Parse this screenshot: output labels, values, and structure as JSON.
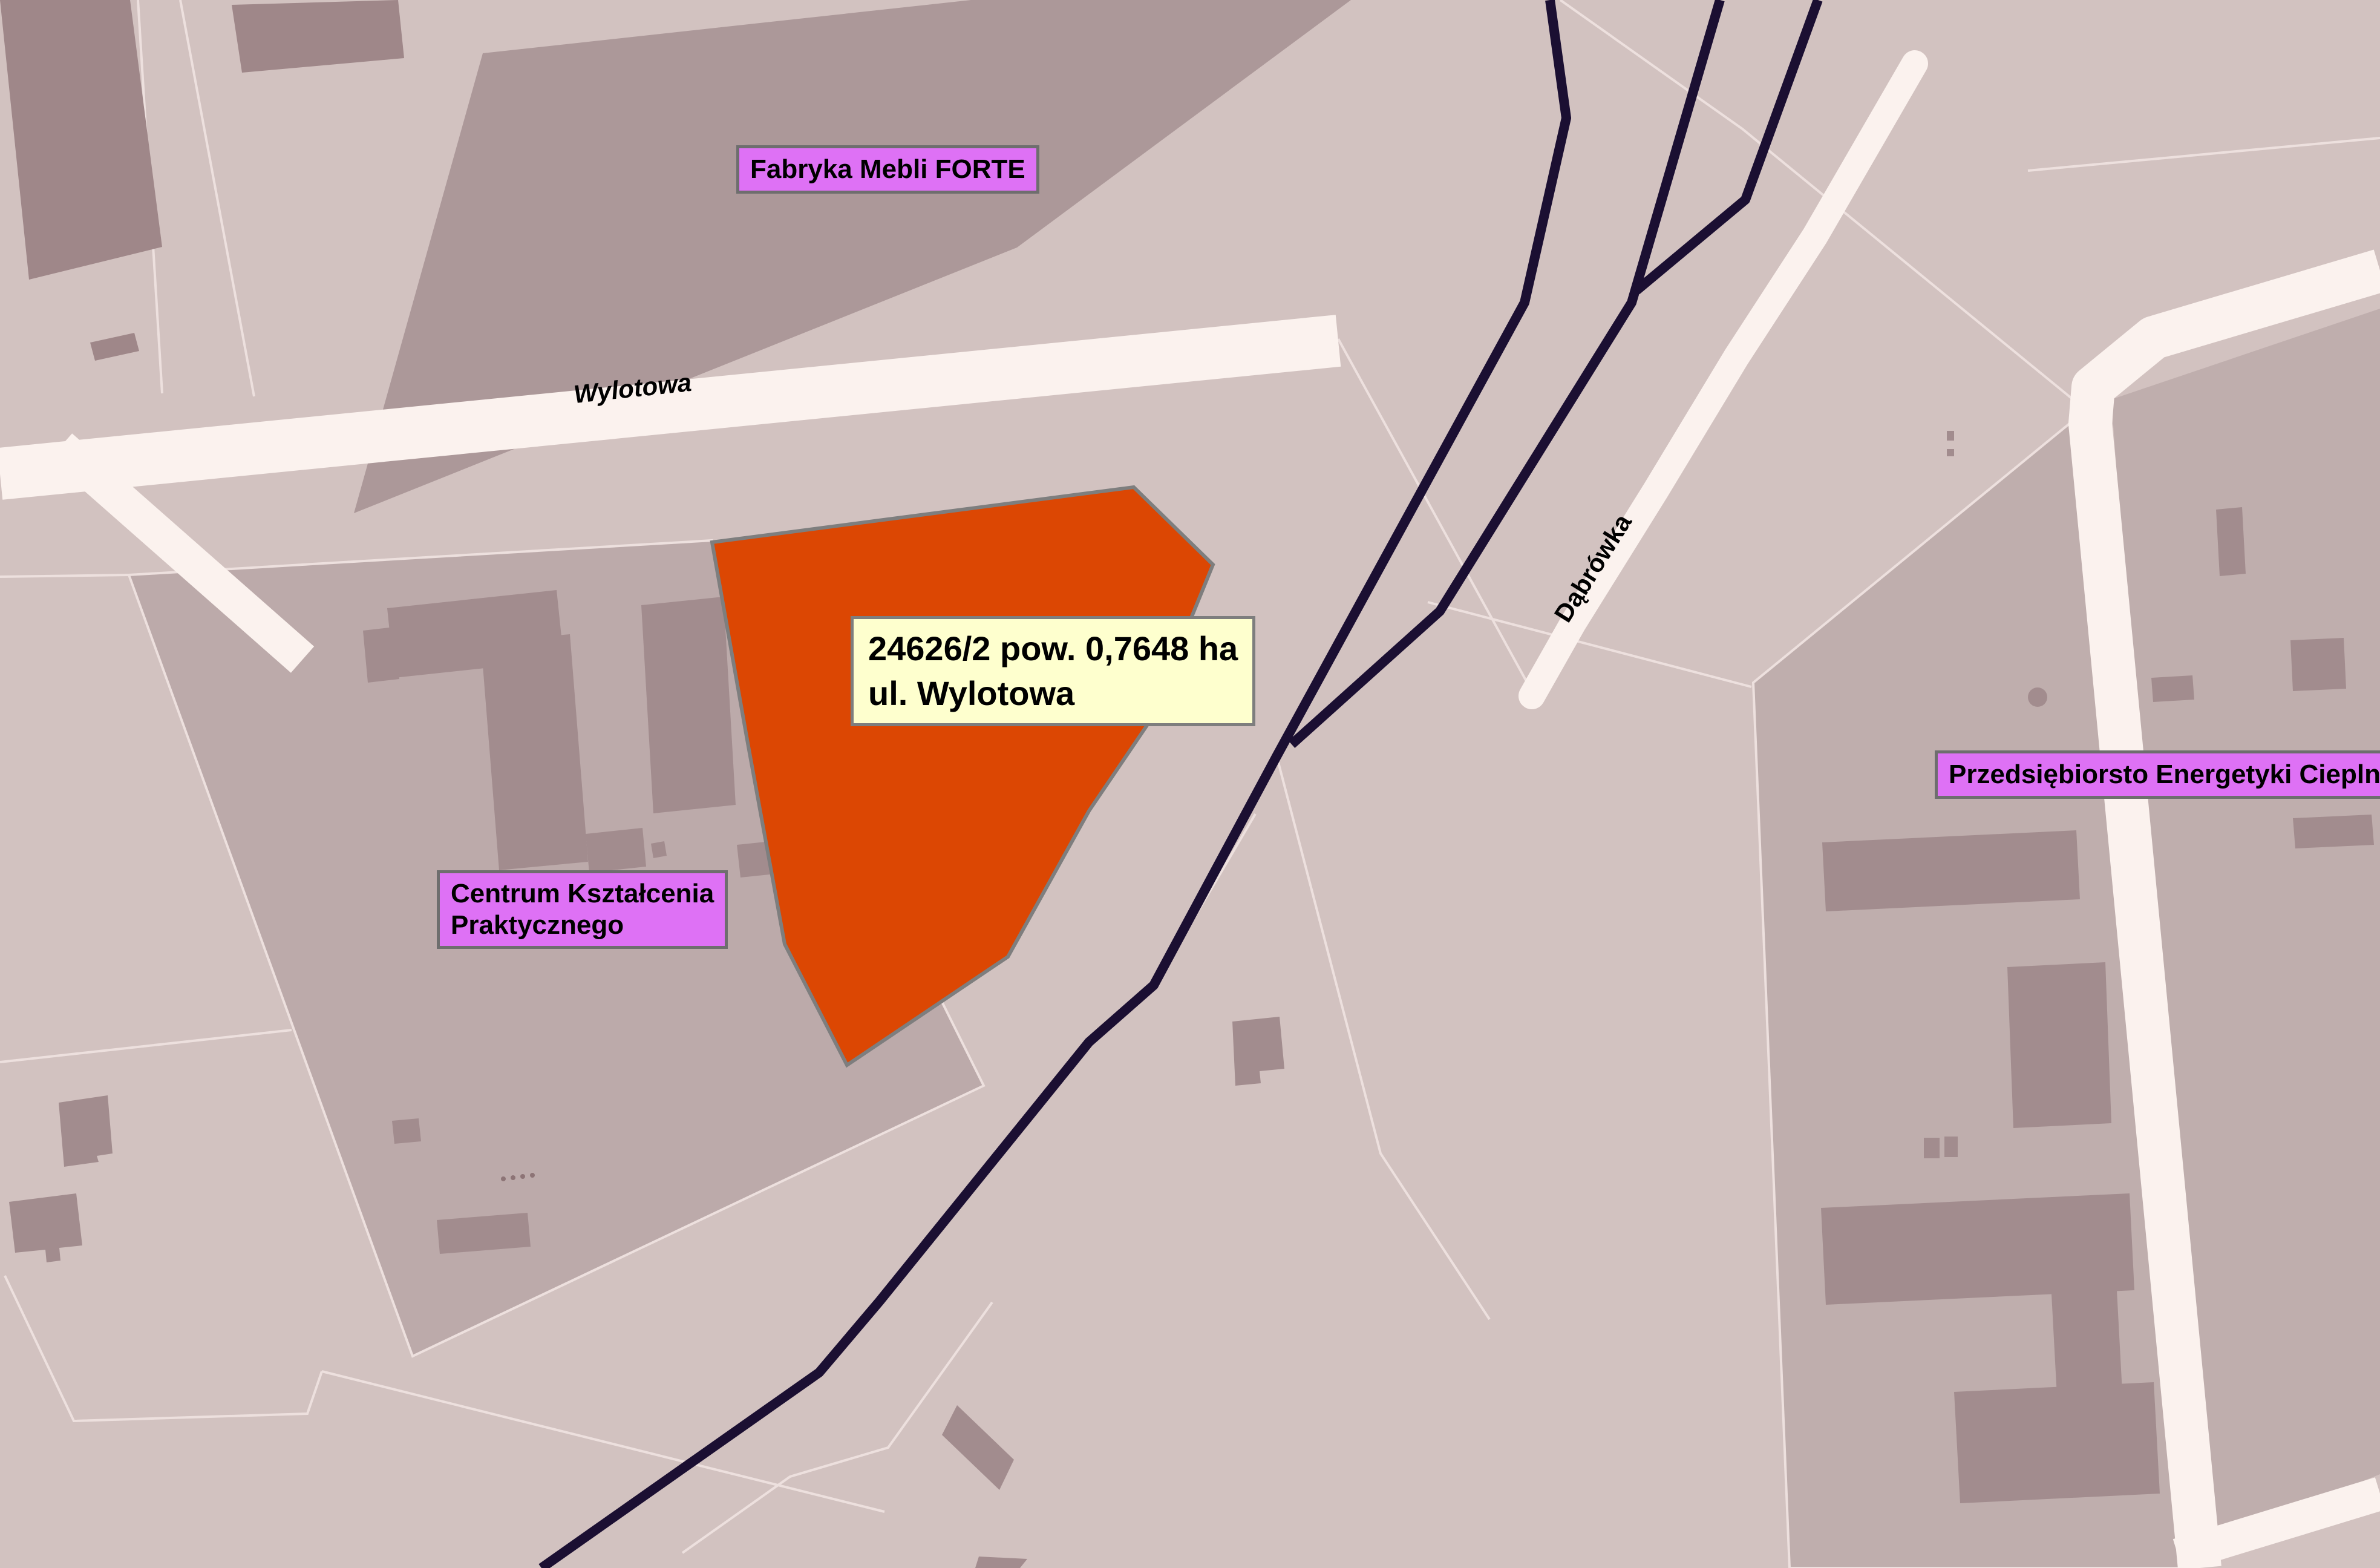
{
  "labels": {
    "forte": "Fabryka Mebli FORTE",
    "centrum_line1": "Centrum Kształcenia",
    "centrum_line2": "Praktycznego",
    "przedsiebiorstwo": "Przedsiębiorsto Energetyki Cieplnej"
  },
  "parcel_info": {
    "line1": "24626/2 pow. 0,7648 ha",
    "line2": "ul. Wylotowa"
  },
  "streets": {
    "wylotowa": "Wylotowa",
    "dabrowka": "Dąbrówka"
  },
  "palette": {
    "base": "#D2C2C0",
    "parcel_dark": "#BCAAAA",
    "parcel_right": "#BFAEAD",
    "forte_area": "#AC9899",
    "building": "#A28C8E",
    "building_dark": "#9F8789",
    "road": "#FBF2EE",
    "boundary": "#EDE0DE",
    "railway": "#1B0F32",
    "parcel_highlight": "#DC4703",
    "parcel_highlight_border": "#7E7E7E",
    "label_bg": "#DE71F5",
    "label_border": "#6E6E6E",
    "info_bg": "#FEFFCE",
    "info_border": "#7E7E7E",
    "text": "#000000",
    "dots": "#8D7476"
  }
}
